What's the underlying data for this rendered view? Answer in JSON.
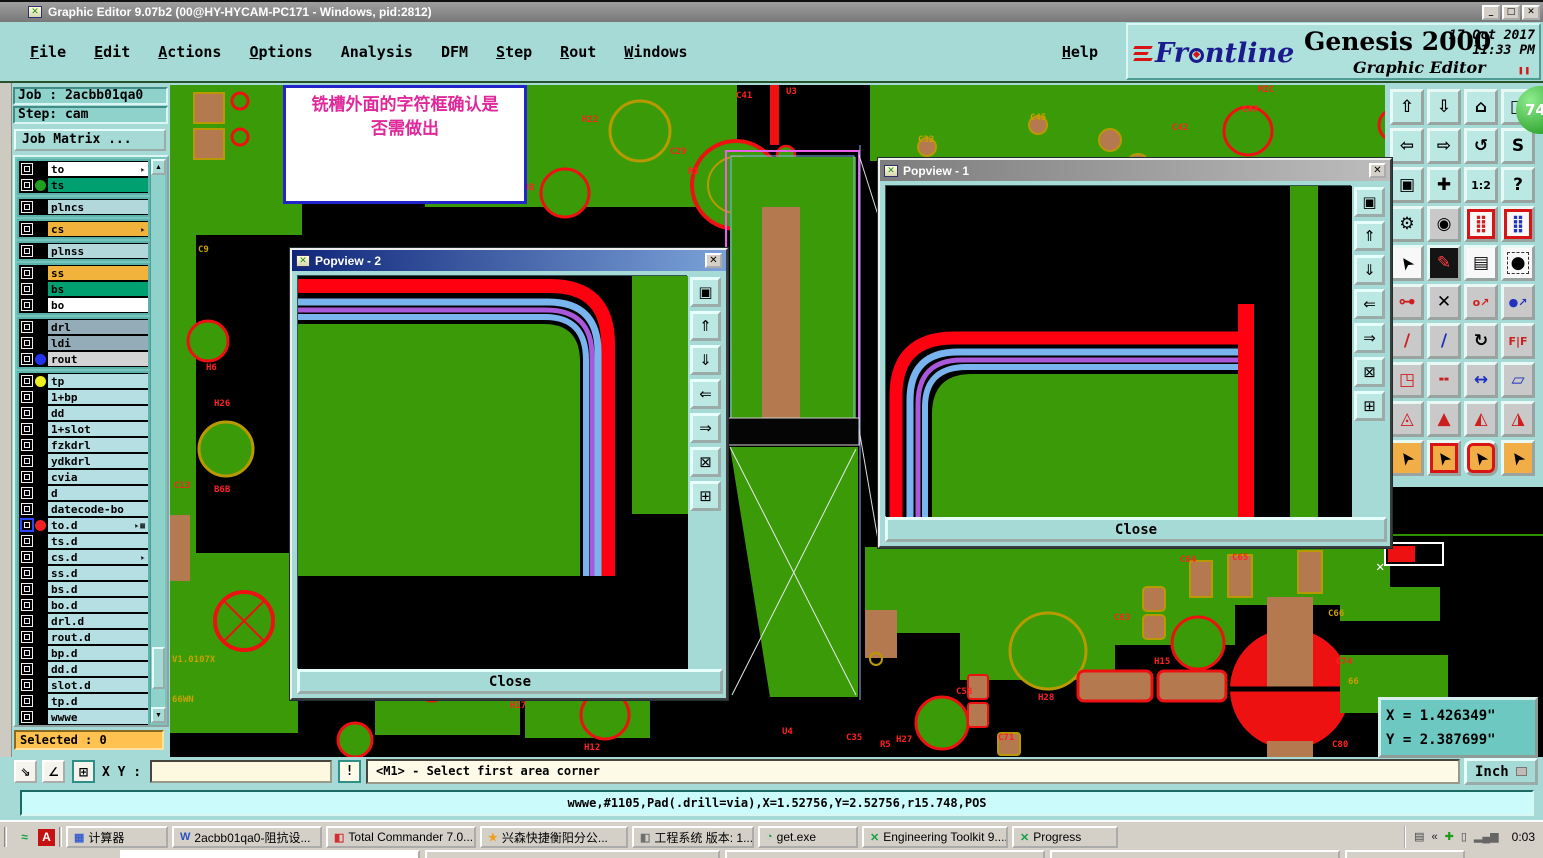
{
  "window": {
    "title": "Graphic Editor 9.07b2 (00@HY-HYCAM-PC171 - Windows, pid:2812)",
    "controls": {
      "minimize": "_",
      "maximize": "□",
      "close": "✕"
    }
  },
  "menus": [
    {
      "label": "File",
      "u": true
    },
    {
      "label": "Edit",
      "u": true
    },
    {
      "label": "Actions",
      "u": true
    },
    {
      "label": "Options",
      "u": true
    },
    {
      "label": "Analysis",
      "u": false
    },
    {
      "label": "DFM",
      "u": false
    },
    {
      "label": "Step",
      "u": true
    },
    {
      "label": "Rout",
      "u": true
    },
    {
      "label": "Windows",
      "u": true
    }
  ],
  "help_label": "Help",
  "brand": {
    "logo": "Frontline",
    "product": "Genesis 2000",
    "subtitle": "Graphic Editor",
    "date": "17 Oct 2017",
    "time": "11:33 PM",
    "pause": "❚❚"
  },
  "badge": "74",
  "job_panel": {
    "job": "Job : 2acbb01qa0",
    "step": "Step: cam",
    "matrix": "Job Matrix ..."
  },
  "layers": [
    {
      "name": "to",
      "bg": "#ffffff",
      "group": 0,
      "icon": "pointer"
    },
    {
      "name": "ts",
      "bg": "#00a070",
      "group": 0,
      "dot": "#1fa01f"
    },
    {
      "name": "plncs",
      "bg": "#b2d8dc",
      "group": 1
    },
    {
      "name": "cs",
      "bg": "#f2b33d",
      "group": 2,
      "icon": "pointer"
    },
    {
      "name": "plnss",
      "bg": "#b2d8dc",
      "group": 3
    },
    {
      "name": "ss",
      "bg": "#f2b33d",
      "group": 4
    },
    {
      "name": "bs",
      "bg": "#00a070",
      "group": 4
    },
    {
      "name": "bo",
      "bg": "#ffffff",
      "group": 4
    },
    {
      "name": "drl",
      "bg": "#94acb8",
      "group": 5
    },
    {
      "name": "ldi",
      "bg": "#94acb8",
      "group": 5
    },
    {
      "name": "rout",
      "bg": "#d4d4d4",
      "group": 5,
      "dot": "#2233ee"
    },
    {
      "name": "tp",
      "bg": "#b6dfe3",
      "group": 6,
      "dot": "#eeee22"
    },
    {
      "name": "1+bp",
      "bg": "#b6dfe3",
      "group": 6
    },
    {
      "name": "dd",
      "bg": "#b6dfe3",
      "group": 6
    },
    {
      "name": "1+slot",
      "bg": "#b6dfe3",
      "group": 6
    },
    {
      "name": "fzkdrl",
      "bg": "#b6dfe3",
      "group": 6
    },
    {
      "name": "ydkdrl",
      "bg": "#b6dfe3",
      "group": 6
    },
    {
      "name": "cvia",
      "bg": "#b6dfe3",
      "group": 6
    },
    {
      "name": "d",
      "bg": "#b6dfe3",
      "group": 6
    },
    {
      "name": "datecode-bo",
      "bg": "#b6dfe3",
      "group": 6
    },
    {
      "name": "to.d",
      "bg": "#b6dfe3",
      "group": 6,
      "dot": "#ee2222",
      "sel": true,
      "icon": "pointer-grid"
    },
    {
      "name": "ts.d",
      "bg": "#b6dfe3",
      "group": 6
    },
    {
      "name": "cs.d",
      "bg": "#b6dfe3",
      "group": 6,
      "icon": "pointer"
    },
    {
      "name": "ss.d",
      "bg": "#b6dfe3",
      "group": 6
    },
    {
      "name": "bs.d",
      "bg": "#b6dfe3",
      "group": 6
    },
    {
      "name": "bo.d",
      "bg": "#b6dfe3",
      "group": 6
    },
    {
      "name": "drl.d",
      "bg": "#b6dfe3",
      "group": 6
    },
    {
      "name": "rout.d",
      "bg": "#b6dfe3",
      "group": 6
    },
    {
      "name": "bp.d",
      "bg": "#b6dfe3",
      "group": 6
    },
    {
      "name": "dd.d",
      "bg": "#b6dfe3",
      "group": 6
    },
    {
      "name": "slot.d",
      "bg": "#b6dfe3",
      "group": 6
    },
    {
      "name": "tp.d",
      "bg": "#b6dfe3",
      "group": 6
    },
    {
      "name": "wwwe",
      "bg": "#b6dfe3",
      "group": 6
    }
  ],
  "selected": "Selected : 0",
  "annotation": {
    "line1": "铣槽外面的字符框确认是",
    "line2": "否需做出"
  },
  "popviews": [
    {
      "title": "Popview - 2",
      "close": "Close"
    },
    {
      "title": "Popview - 1",
      "close": "Close"
    }
  ],
  "popview_buttons": [
    {
      "name": "popout-view-button",
      "glyph": "▣"
    },
    {
      "name": "scroll-up-button",
      "glyph": "⇑"
    },
    {
      "name": "scroll-down-button",
      "glyph": "⇓"
    },
    {
      "name": "scroll-left-button",
      "glyph": "⇐"
    },
    {
      "name": "scroll-right-button",
      "glyph": "⇒"
    },
    {
      "name": "zoom-extents-button",
      "glyph": "⊠"
    },
    {
      "name": "pan-view-button",
      "glyph": "⊞"
    }
  ],
  "toolbar": {
    "buttons": [
      {
        "name": "zoom-up-button",
        "glyph": "⇧",
        "cls": "teal"
      },
      {
        "name": "zoom-down-button",
        "glyph": "⇩",
        "cls": "teal"
      },
      {
        "name": "home-view-button",
        "glyph": "⌂",
        "cls": "teal"
      },
      {
        "name": "tile-windows-button",
        "glyph": "◫",
        "cls": "teal"
      },
      {
        "name": "pan-left-button",
        "glyph": "⇦",
        "cls": "teal"
      },
      {
        "name": "pan-right-button",
        "glyph": "⇨",
        "cls": "teal"
      },
      {
        "name": "previous-view-button",
        "glyph": "↺",
        "cls": "teal"
      },
      {
        "name": "serpentine-button",
        "glyph": "S",
        "cls": "teal"
      },
      {
        "name": "corner-zoom-button",
        "glyph": "▣",
        "cls": "teal"
      },
      {
        "name": "center-view-button",
        "glyph": "✚",
        "cls": "teal"
      },
      {
        "name": "zoom-1-2-button",
        "glyph": "1:2",
        "cls": "teal",
        "sm": true
      },
      {
        "name": "help-button",
        "glyph": "?",
        "cls": "teal"
      },
      {
        "name": "setup-button",
        "glyph": "⚙",
        "cls": "teal"
      },
      {
        "name": "probe-button",
        "glyph": "◉",
        "cls": "gray"
      },
      {
        "name": "netlist-check-button",
        "glyph": "⣿",
        "cls": "white fr",
        "fg": "#cc2020"
      },
      {
        "name": "netlist-compare-button",
        "glyph": "⣿",
        "cls": "white fr",
        "fg": "#2030c0"
      },
      {
        "name": "select-pointer-button",
        "glyph": "➤",
        "cls": "white",
        "rot": true
      },
      {
        "name": "edit-marker-button",
        "glyph": "✎",
        "cls": "black",
        "fg": "#ff4040"
      },
      {
        "name": "ruler-button",
        "glyph": "▤",
        "cls": "white"
      },
      {
        "name": "pad-capture-button",
        "glyph": "●",
        "cls": "white",
        "dash": true
      },
      {
        "name": "link-nets-button",
        "glyph": "⊶",
        "cls": "gray",
        "fg": "#cc2020"
      },
      {
        "name": "erase-button",
        "glyph": "✕",
        "cls": "gray"
      },
      {
        "name": "grow-dot-button",
        "glyph": "o↗",
        "cls": "gray",
        "fg": "#cc2020",
        "sm": true
      },
      {
        "name": "move-dot-button",
        "glyph": "●↗",
        "cls": "gray",
        "fg": "#2030c0",
        "sm": true
      },
      {
        "name": "slant-up-button",
        "glyph": "/",
        "cls": "gray",
        "fg": "#cc2020"
      },
      {
        "name": "slant-line-button",
        "glyph": "/",
        "cls": "gray",
        "fg": "#2030c0"
      },
      {
        "name": "rotate-button",
        "glyph": "↻",
        "cls": "gray"
      },
      {
        "name": "mirror-button",
        "glyph": "F|F",
        "cls": "gray",
        "fg": "#cc2020",
        "sm": true
      },
      {
        "name": "corner-move-button",
        "glyph": "◳",
        "cls": "gray",
        "fg": "#cc2020"
      },
      {
        "name": "stretch-button",
        "glyph": "╍",
        "cls": "gray",
        "fg": "#cc2020"
      },
      {
        "name": "measure-gap-button",
        "glyph": "↔",
        "cls": "gray",
        "fg": "#2030c0"
      },
      {
        "name": "copy-shape-button",
        "glyph": "▱",
        "cls": "gray",
        "fg": "#2030c0"
      },
      {
        "name": "peak-open-button",
        "glyph": "◬",
        "cls": "gray",
        "fg": "#cc2020"
      },
      {
        "name": "peak-solid-button",
        "glyph": "▲",
        "cls": "gray",
        "fg": "#cc2020"
      },
      {
        "name": "peak-left-button",
        "glyph": "◭",
        "cls": "gray",
        "fg": "#cc2020"
      },
      {
        "name": "peak-right-button",
        "glyph": "◮",
        "cls": "gray",
        "fg": "#cc2020"
      },
      {
        "name": "cursor-plain-button",
        "glyph": "➤",
        "cls": "orange",
        "rot": true
      },
      {
        "name": "cursor-box-button",
        "glyph": "➤",
        "cls": "orange fr",
        "rot": true
      },
      {
        "name": "cursor-round-button",
        "glyph": "➤",
        "cls": "orange rr",
        "rot": true
      },
      {
        "name": "route-cursor-button",
        "glyph": "➤",
        "cls": "orange",
        "rot": true
      }
    ]
  },
  "coords": {
    "x": "X = 1.426349\"",
    "y": "Y = 2.387699\""
  },
  "command_bar": {
    "xy_label": "X Y :",
    "input_value": "",
    "alert": "!",
    "message": "<M1> - Select first area corner",
    "units": "Inch"
  },
  "info_bar": "wwwe,#1105,Pad(.drill=via),X=1.52756,Y=2.52756,r15.748,POS",
  "pcb_labels": [
    {
      "t": "H22",
      "x": 412,
      "y": 30
    },
    {
      "t": "C29",
      "x": 500,
      "y": 62
    },
    {
      "t": "R3",
      "x": 518,
      "y": 82
    },
    {
      "t": "13B",
      "x": 348,
      "y": 98
    },
    {
      "t": "C41",
      "x": 566,
      "y": 6
    },
    {
      "t": "U3",
      "x": 616,
      "y": 2
    },
    {
      "t": "C9",
      "x": 28,
      "y": 160,
      "g": 1
    },
    {
      "t": "H6",
      "x": 36,
      "y": 278
    },
    {
      "t": "H26",
      "x": 44,
      "y": 314
    },
    {
      "t": "C13",
      "x": 4,
      "y": 396
    },
    {
      "t": "B6B",
      "x": 44,
      "y": 400
    },
    {
      "t": "C32",
      "x": 748,
      "y": 50,
      "g": 1
    },
    {
      "t": "C45",
      "x": 860,
      "y": 28,
      "g": 1
    },
    {
      "t": "MIC",
      "x": 1088,
      "y": 0
    },
    {
      "t": "C47",
      "x": 1072,
      "y": 20
    },
    {
      "t": "C42",
      "x": 1002,
      "y": 38
    },
    {
      "t": "V1.0107X",
      "x": 2,
      "y": 570,
      "g": 1
    },
    {
      "t": "66WN",
      "x": 2,
      "y": 610,
      "g": 1
    },
    {
      "t": "H17",
      "x": 340,
      "y": 616
    },
    {
      "t": "H12",
      "x": 414,
      "y": 658
    },
    {
      "t": "U4",
      "x": 612,
      "y": 642
    },
    {
      "t": "C35",
      "x": 676,
      "y": 648
    },
    {
      "t": "R5",
      "x": 710,
      "y": 655
    },
    {
      "t": "C64",
      "x": 1010,
      "y": 470
    },
    {
      "t": "C65",
      "x": 1062,
      "y": 468
    },
    {
      "t": "C63",
      "x": 944,
      "y": 528
    },
    {
      "t": "C66",
      "x": 1158,
      "y": 524,
      "g": 1
    },
    {
      "t": "H15",
      "x": 984,
      "y": 572
    },
    {
      "t": "C74",
      "x": 1166,
      "y": 572
    },
    {
      "t": "C58",
      "x": 786,
      "y": 602
    },
    {
      "t": "H28",
      "x": 868,
      "y": 608
    },
    {
      "t": "C71",
      "x": 828,
      "y": 648
    },
    {
      "t": "H27",
      "x": 726,
      "y": 650
    },
    {
      "t": "C80",
      "x": 1162,
      "y": 655
    },
    {
      "t": "66",
      "x": 1178,
      "y": 592,
      "g": 1
    }
  ],
  "taskbar": {
    "quick": [
      {
        "name": "quick-launch-icon",
        "glyph": "≈",
        "color": "#18a048",
        "bg": ""
      },
      {
        "name": "pdf-icon",
        "glyph": "A",
        "color": "#ffffff",
        "bg": "#c41212"
      }
    ],
    "items": [
      {
        "label": "计算器",
        "icon": "calculator-icon",
        "glyph": "▦",
        "ic": "#3a5fcd",
        "w": 102
      },
      {
        "label": "2acbb01qa0-阻抗设...",
        "icon": "word-doc-icon",
        "glyph": "W",
        "ic": "#2a52be",
        "w": 150
      },
      {
        "label": "Total Commander 7.0...",
        "icon": "total-commander-icon",
        "glyph": "◧",
        "ic": "#d03030",
        "w": 150
      },
      {
        "label": "兴森快捷衡阳分公...",
        "icon": "star-icon",
        "glyph": "★",
        "ic": "#f0a020",
        "w": 148
      },
      {
        "label": "工程系统 版本: 1....",
        "icon": "system-app-icon",
        "glyph": "◧",
        "ic": "#707070",
        "w": 122
      },
      {
        "label": "get.exe",
        "icon": "globe-icon",
        "glyph": "◔",
        "ic": "#18a048",
        "w": 100
      },
      {
        "label": "Engineering Toolkit 9....",
        "icon": "genesis-icon",
        "glyph": "✕",
        "ic": "#18a048",
        "w": 146
      },
      {
        "label": "Progress",
        "icon": "genesis-icon",
        "glyph": "✕",
        "ic": "#18a048",
        "w": 106
      }
    ],
    "tray": [
      {
        "name": "printer-icon",
        "glyph": "▤",
        "color": "#444"
      },
      {
        "name": "collapse-chevrons-icon",
        "glyph": "«",
        "color": "#222"
      },
      {
        "name": "antivirus-icon",
        "glyph": "✚",
        "color": "#1a9a1a"
      },
      {
        "name": "clipboard-icon",
        "glyph": "▯",
        "color": "#444"
      },
      {
        "name": "network-signal-icon",
        "glyph": "▂▄▆",
        "color": "#666"
      }
    ],
    "clock": "0:03"
  }
}
